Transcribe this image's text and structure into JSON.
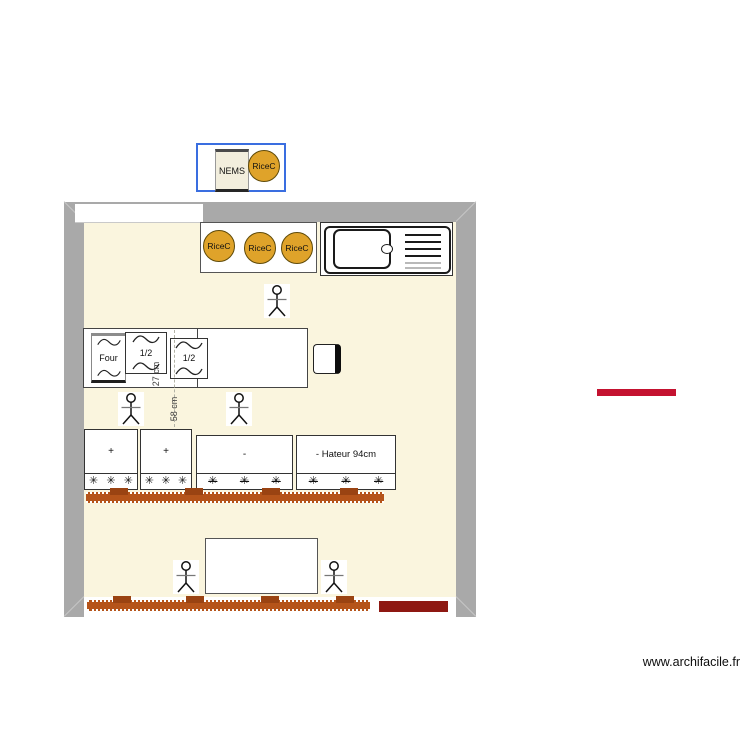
{
  "legend": {
    "nems_label": "NEMS",
    "rice_label": "RiceC"
  },
  "plan": {
    "rice_circles": [
      {
        "label": "RiceC"
      },
      {
        "label": "RiceC"
      },
      {
        "label": "RiceC"
      }
    ],
    "appliances": {
      "oven_label": "Four",
      "half_left_label": "1/2",
      "half_right_label": "1/2"
    },
    "dimensions": {
      "depth_label": "27 cm",
      "gap_label": "58 cm"
    },
    "worktops": [
      {
        "label": "+"
      },
      {
        "label": "+"
      },
      {
        "label": "-"
      },
      {
        "label": "- Hateur 94cm"
      }
    ],
    "burner_glyph": "✳"
  },
  "colors": {
    "wall_gray": "#a9a9a9",
    "floor_cream": "#faf5de",
    "legend_border_blue": "#3a6ee0",
    "rice_circle_fill": "#dfa32a",
    "rice_circle_border": "#5f4a08",
    "heater_orange": "#b5541a",
    "heater_tooth_brown": "#9a4312",
    "door_dark_red": "#8e1812",
    "marker_red": "#c41230"
  },
  "icons": {
    "person": "stick-figure-icon",
    "sink": "kitchen-sink-icon",
    "wave": "steam-wave-icon",
    "burner": "burner-asterisk-icon"
  },
  "watermark": {
    "text": "www.archifacile.fr"
  }
}
